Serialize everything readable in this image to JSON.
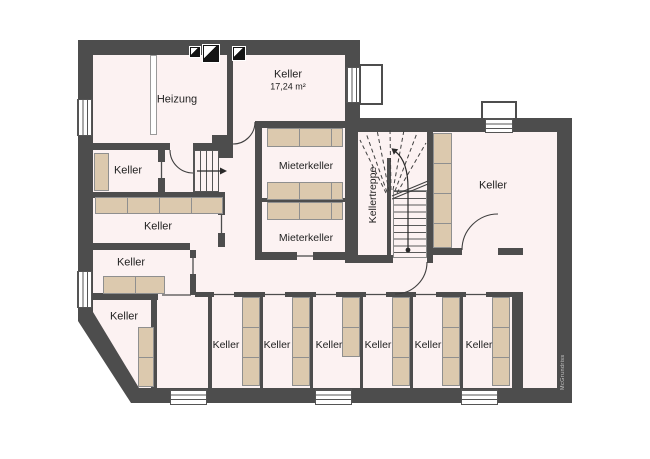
{
  "watermark": "McGrundriss",
  "colors": {
    "wall": "#4d4d4d",
    "floor": "#fcf2f2",
    "shelf": "#dcc9ae"
  },
  "rooms": {
    "heizung": {
      "label": "Heizung"
    },
    "keller_top": {
      "label": "Keller",
      "area": "17,24 m²"
    },
    "mieterkeller_a": {
      "label": "Mieterkeller"
    },
    "mieterkeller_b": {
      "label": "Mieterkeller"
    },
    "kellertreppe": {
      "label": "Kellertreppe"
    },
    "keller_right": {
      "label": "Keller"
    },
    "keller_w1": {
      "label": "Keller"
    },
    "keller_w2": {
      "label": "Keller"
    },
    "keller_w3": {
      "label": "Keller"
    },
    "keller_w4": {
      "label": "Keller"
    },
    "keller_s1": {
      "label": "Keller"
    },
    "keller_s2": {
      "label": "Keller"
    },
    "keller_s3": {
      "label": "Keller"
    },
    "keller_s4": {
      "label": "Keller"
    },
    "keller_s5": {
      "label": "Keller"
    },
    "keller_s6": {
      "label": "Keller"
    }
  }
}
